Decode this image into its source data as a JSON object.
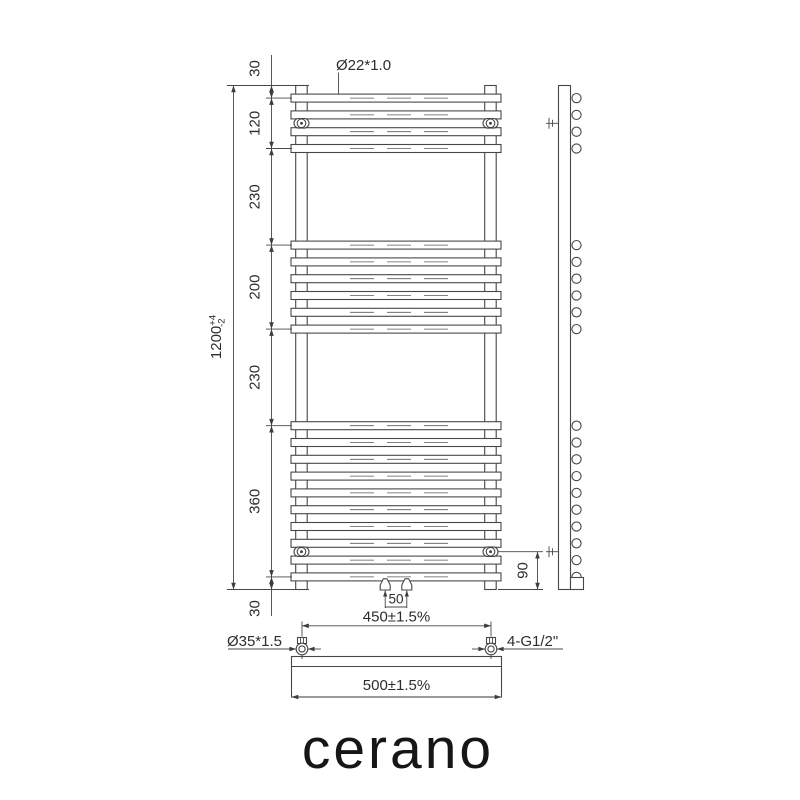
{
  "brand": "cerano",
  "views": {
    "front": {
      "bar_pitch_mm": 40,
      "total_height_mm": 1200,
      "bar_groups": [
        {
          "bars": 4,
          "start_mm": 30
        },
        {
          "bars": 6,
          "start_mm": 380
        },
        {
          "bars": 10,
          "start_mm": 810
        }
      ],
      "bracket_top_mm": 90,
      "bracket_bottom_mm": 1110
    },
    "dimensions": {
      "tube_label": "Ø22*1.0",
      "height_chain": [
        {
          "label": "30",
          "mm": 30
        },
        {
          "label": "120",
          "mm": 120
        },
        {
          "label": "230",
          "mm": 230
        },
        {
          "label": "200",
          "mm": 200
        },
        {
          "label": "230",
          "mm": 230
        },
        {
          "label": "360",
          "mm": 360
        },
        {
          "label": "30",
          "mm": 30
        }
      ],
      "total_height": {
        "value": "1200",
        "tol_plus": "+4",
        "tol_minus": "-2"
      },
      "bracket_to_bottom": "90",
      "valve_spacing": "50",
      "axis_spacing": "450±1.5%",
      "overall_width": "500±1.5%",
      "collector_tube_label": "Ø35*1.5",
      "thread_label": "4-G1/2\""
    }
  }
}
